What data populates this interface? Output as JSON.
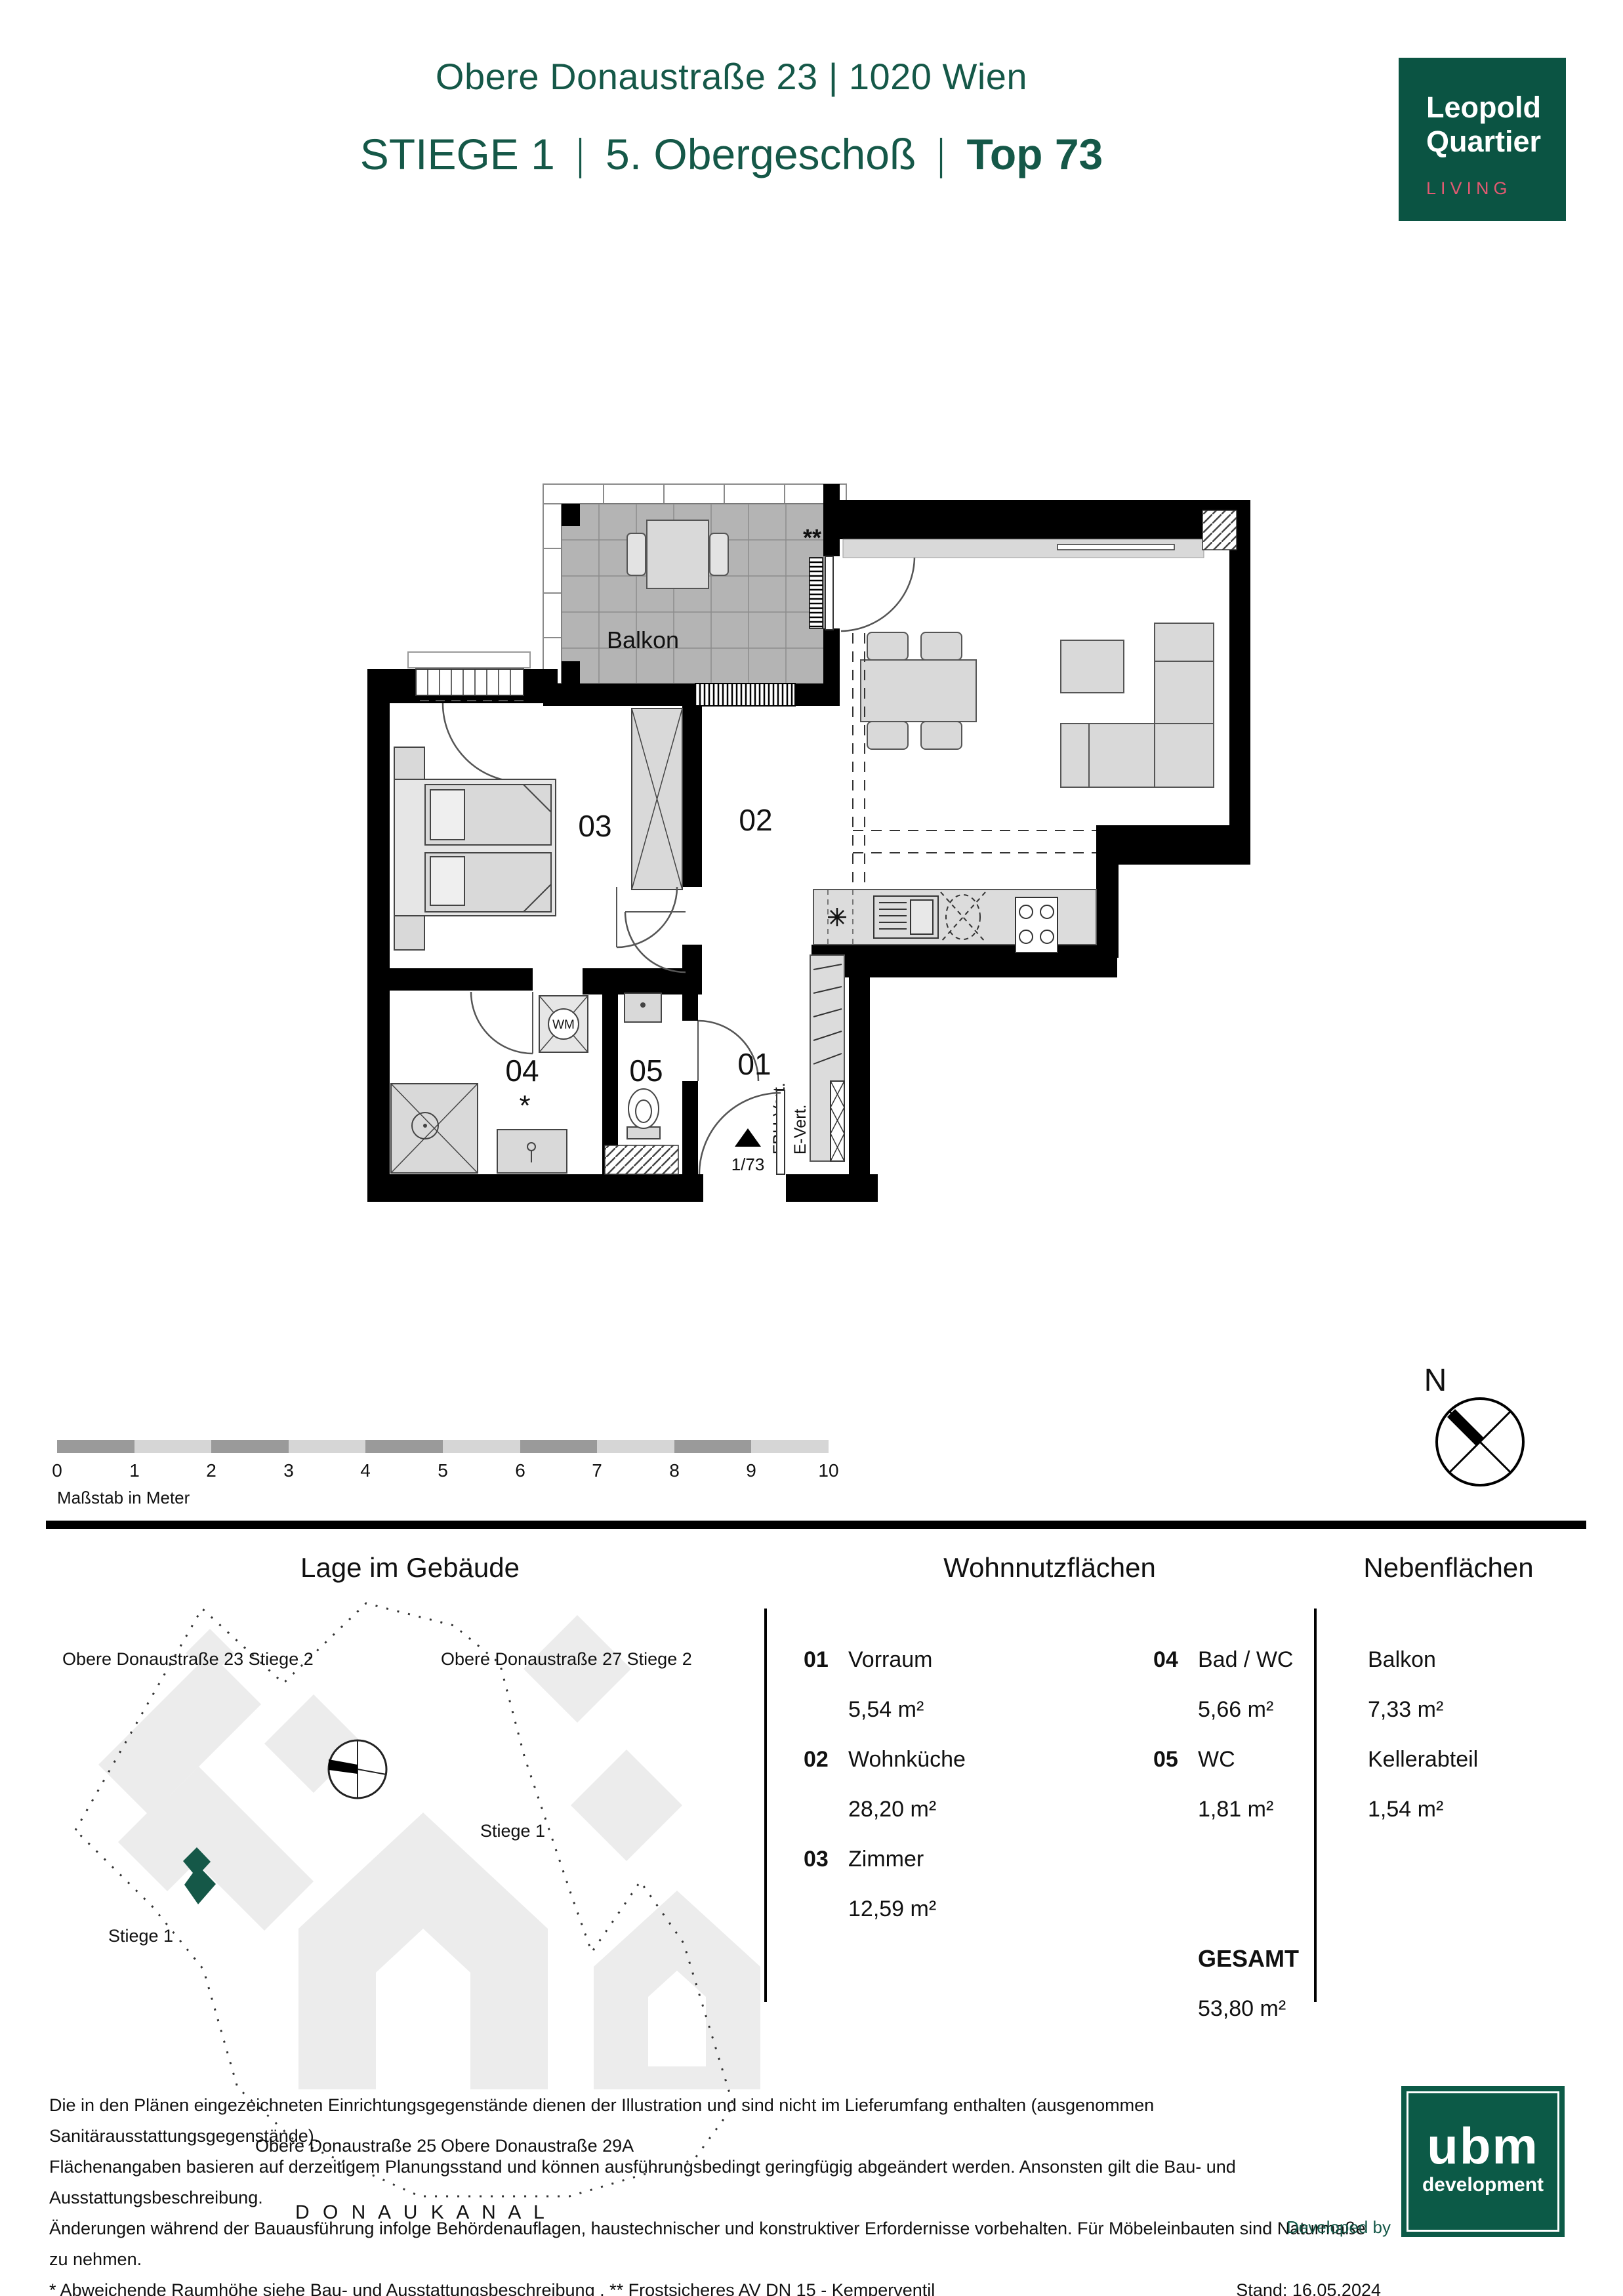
{
  "colors": {
    "brand_green": "#155848",
    "logo_green": "#0B5443",
    "living_pink": "#E25A72",
    "ubm_green": "#0C5A47",
    "wall_black": "#000000",
    "furniture_gray": "#D9D9D9",
    "tile_gray": "#B4B4B4",
    "site_gray": "#ECECEC"
  },
  "header": {
    "address": "Obere Donaustraße 23 | 1020 Wien",
    "stiege": "STIEGE 1",
    "sep": "|",
    "floor": "5. Obergeschoß",
    "top": "Top 73"
  },
  "brand_logo": {
    "line1": "Leopold",
    "line2": "Quartier",
    "tagline": "LIVING"
  },
  "plan": {
    "balcony": "Balkon",
    "double_star": "**",
    "star": "*",
    "room_01": "01",
    "room_02": "02",
    "room_03": "03",
    "room_04": "04",
    "room_05": "05",
    "wm": "WM",
    "fbh": "FBH-Vert.",
    "evert": "E-Vert.",
    "unit_marker": "1/73"
  },
  "compass": {
    "north": "N"
  },
  "scalebar": {
    "ticks": [
      "0",
      "1",
      "2",
      "3",
      "4",
      "5",
      "6",
      "7",
      "8",
      "9",
      "10"
    ],
    "caption": "Maßstab in Meter"
  },
  "sections": {
    "site": "Lage im Gebäude",
    "living": "Wohnnutzflächen",
    "ancillary": "Nebenflächen"
  },
  "site_plan": {
    "labels": {
      "bldg23": "Obere Donaustraße 23 Stiege 2",
      "bldg27": "Obere Donaustraße 27 Stiege 2",
      "stiege1_right": "Stiege 1",
      "stiege1_left": "Stiege 1",
      "bldg25": "Obere Donaustraße 25",
      "bldg29a": "Obere Donaustraße 29A",
      "canal": "D O N A U K A N A L"
    }
  },
  "living_areas": {
    "items": [
      {
        "num": "01",
        "name": "Vorraum",
        "area": "5,54 m²"
      },
      {
        "num": "02",
        "name": "Wohnküche",
        "area": "28,20 m²"
      },
      {
        "num": "03",
        "name": "Zimmer",
        "area": "12,59 m²"
      },
      {
        "num": "04",
        "name": "Bad / WC",
        "area": "5,66 m²"
      },
      {
        "num": "05",
        "name": "WC",
        "area": "1,81 m²"
      }
    ],
    "total_label": "GESAMT",
    "total_area": "53,80 m²"
  },
  "ancillary_areas": {
    "items": [
      {
        "name": "Balkon",
        "area": "7,33 m²"
      },
      {
        "name": "Kellerabteil",
        "area": "1,54 m²"
      }
    ]
  },
  "footer": {
    "lines": [
      "Die in den Plänen eingezeichneten Einrichtungsgegenstände dienen der Illustration und sind nicht im Lieferumfang enthalten (ausgenommen Sanitärausstattungsgegenstände).",
      "Flächenangaben basieren auf derzeitigem Planungsstand und können ausführungsbedingt geringfügig abgeändert werden. Ansonsten gilt die Bau- und Ausstattungsbeschreibung.",
      "Änderungen während der Bauausführung infolge Behördenauflagen, haustechnischer und konstruktiver Erfordernisse vorbehalten. Für Möbeleinbauten sind Naturmaße zu nehmen.",
      "* Abweichende Raumhöhe siehe Bau- und Ausstattungsbeschreibung . ** Frostsicheres AV DN 15 - Kemperventil"
    ],
    "stand": "Stand: 16.05.2024",
    "developed_by": "Developed by"
  },
  "dev_logo": {
    "name": "ubm",
    "sub": "development"
  }
}
